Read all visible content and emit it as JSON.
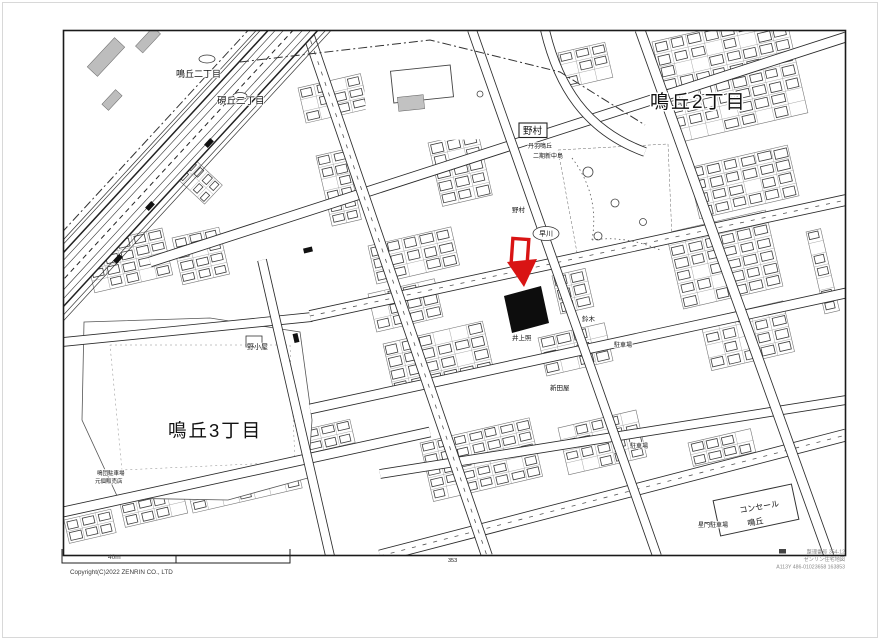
{
  "page": {
    "page_number": "353",
    "copyright": "Copyright(C)2022 ZENRIN CO., LTD",
    "scale_label": "40m",
    "footer_right": [
      "整理番号 354-12",
      "ゼンリン住宅地図",
      "A113Y 486-01023658 163853"
    ]
  },
  "districts": {
    "ne_large": "鳴丘2丁目",
    "sw_large": "鳴丘3丁目",
    "small_upper": "鳴丘二丁目",
    "small_lower": "硯丘二丁目"
  },
  "marker": {
    "arrow_color": "#d91414",
    "parcel_color": "#0d0d0d"
  },
  "labels": [
    {
      "t": "野村",
      "x": 523,
      "y": 134,
      "s": 9.5,
      "box": true
    },
    {
      "t": "丹羽鳴丘",
      "x": 528,
      "y": 148,
      "s": 6
    },
    {
      "t": "二期新中島",
      "x": 533,
      "y": 158,
      "s": 6
    },
    {
      "t": "野村",
      "x": 512,
      "y": 212,
      "s": 6.5
    },
    {
      "t": "早川",
      "x": 539,
      "y": 236,
      "s": 7,
      "ellipse": true
    },
    {
      "t": "鈴木",
      "x": 582,
      "y": 321,
      "s": 6.5
    },
    {
      "t": "井上照",
      "x": 512,
      "y": 340,
      "s": 6.5
    },
    {
      "t": "新田屋",
      "x": 550,
      "y": 390,
      "s": 6.5
    },
    {
      "t": "駐車場",
      "x": 614,
      "y": 347,
      "s": 6
    },
    {
      "t": "駐車場",
      "x": 630,
      "y": 448,
      "s": 6
    },
    {
      "t": "星門駐車場",
      "x": 698,
      "y": 527,
      "s": 6
    },
    {
      "t": "コンセール",
      "x": 740,
      "y": 513,
      "s": 8,
      "rot": -10
    },
    {
      "t": "鳴丘",
      "x": 748,
      "y": 526,
      "s": 8,
      "rot": -10
    },
    {
      "t": "野小屋",
      "x": 247,
      "y": 349,
      "s": 7
    },
    {
      "t": "鳴団駐車場",
      "x": 97,
      "y": 475,
      "s": 5.5
    },
    {
      "t": "元個販売店",
      "x": 95,
      "y": 483,
      "s": 5.5
    }
  ]
}
